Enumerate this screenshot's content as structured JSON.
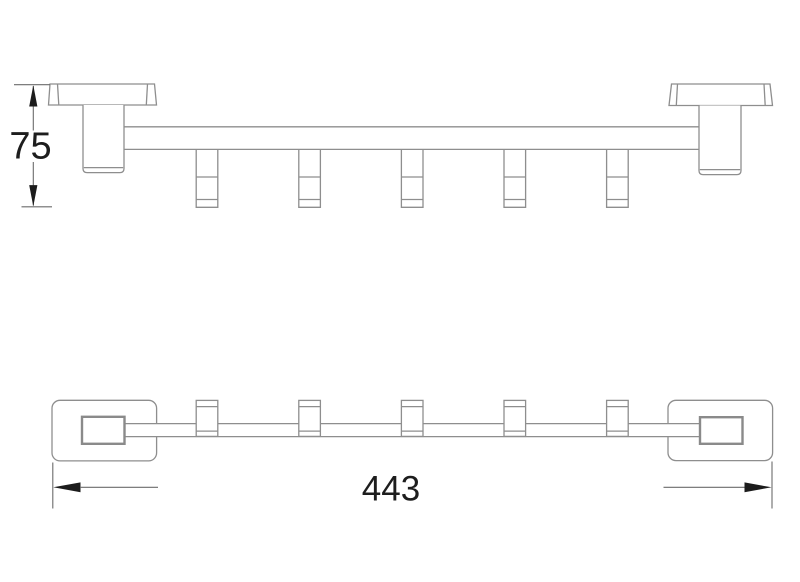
{
  "drawing": {
    "title": "towel-hook-rail-technical-drawing",
    "side_view": {
      "height_dimension": "75",
      "hook_count": 5
    },
    "plan_view": {
      "width_dimension": "443",
      "hook_count": 5
    },
    "colors": {
      "background": "#ffffff",
      "geometry_line": "#8e8e8e",
      "dimension_line": "#6b6b6b",
      "dimension_text": "#1d1d1d",
      "arrow": "#1c1c1c"
    }
  }
}
